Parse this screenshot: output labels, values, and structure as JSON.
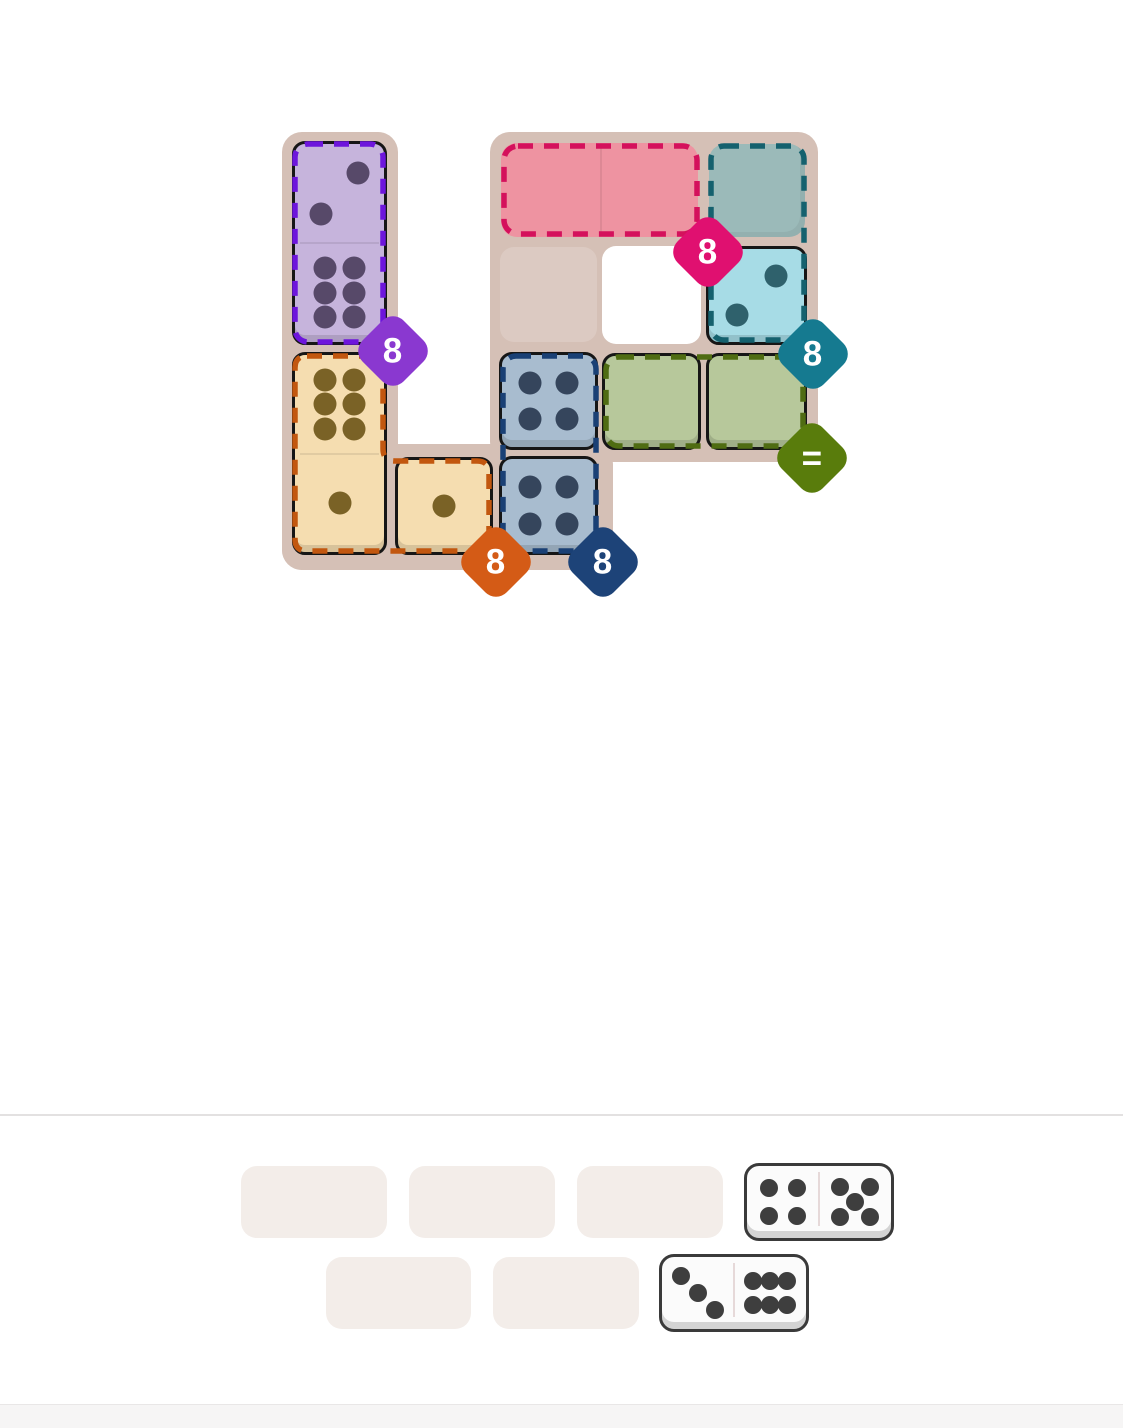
{
  "page": {
    "background": "#ffffff",
    "divider_color": "#e3e1e1",
    "footer_background": "#f6f5f5"
  },
  "board": {
    "background": "#d5c0b6",
    "outline_color": "#161616",
    "empty_cell_color": "#dccac2",
    "hole_color": "#ffffff",
    "pink_zone_fill": "#ee93a1",
    "teal_zone_fill": "#9bbab9",
    "zones": {
      "purple": {
        "name": "purple-zone",
        "badge_label": "8",
        "badge_color": "#8a38d0",
        "dash_color": "#6d15dc"
      },
      "pink": {
        "name": "pink-zone",
        "badge_label": "8",
        "badge_color": "#e01070",
        "dash_color": "#d4115c"
      },
      "teal": {
        "name": "teal-zone",
        "badge_label": "8",
        "badge_color": "#157a90",
        "dash_color": "#15616e"
      },
      "navy": {
        "name": "navy-zone",
        "badge_label": "8",
        "badge_color": "#1d4378",
        "dash_color": "#1a4075"
      },
      "olive": {
        "name": "olive-zone",
        "badge_label": "=",
        "badge_color": "#597c0c",
        "dash_color": "#4f6c12"
      },
      "orange": {
        "name": "orange-zone",
        "badge_label": "8",
        "badge_color": "#d45b16",
        "dash_color": "#c2570f"
      }
    },
    "pieces": {
      "purple_domino": {
        "fill": "#c6b4dc",
        "pip_color": "#574969",
        "top_pips": 2,
        "bottom_pips": 6
      },
      "orange_domino": {
        "fill": "#f5ddb0",
        "pip_color": "#7a6226",
        "top_pips": 6,
        "bottom_pips": 1
      },
      "tan_square": {
        "fill": "#f5ddb0",
        "pip_color": "#7a6226",
        "pips": 1
      },
      "blue_square_top": {
        "fill": "#a8bccf",
        "pip_color": "#35455c",
        "pips": 4
      },
      "blue_square_bottom": {
        "fill": "#a8bccf",
        "pip_color": "#35455c",
        "pips": 4
      },
      "green_square_left": {
        "fill": "#b7c89b",
        "pip_color": "#4e5b33",
        "pips": 0
      },
      "green_square_right": {
        "fill": "#b7c89b",
        "pip_color": "#4e5b33",
        "pips": 0
      },
      "cyan_square": {
        "fill": "#a7dce6",
        "pip_color": "#2f616c",
        "pips": 2
      }
    }
  },
  "tray": {
    "slot_color": "#f3ede9",
    "domino_face": "#fbfbfb",
    "domino_border": "#3a3a3a",
    "pip_color": "#3e3e3e",
    "dominoes": {
      "first": {
        "name": "tray-domino-4-5",
        "left_pips": 4,
        "right_pips": 5
      },
      "second": {
        "name": "tray-domino-3-6",
        "left_pips": 3,
        "right_pips": 6
      }
    }
  }
}
